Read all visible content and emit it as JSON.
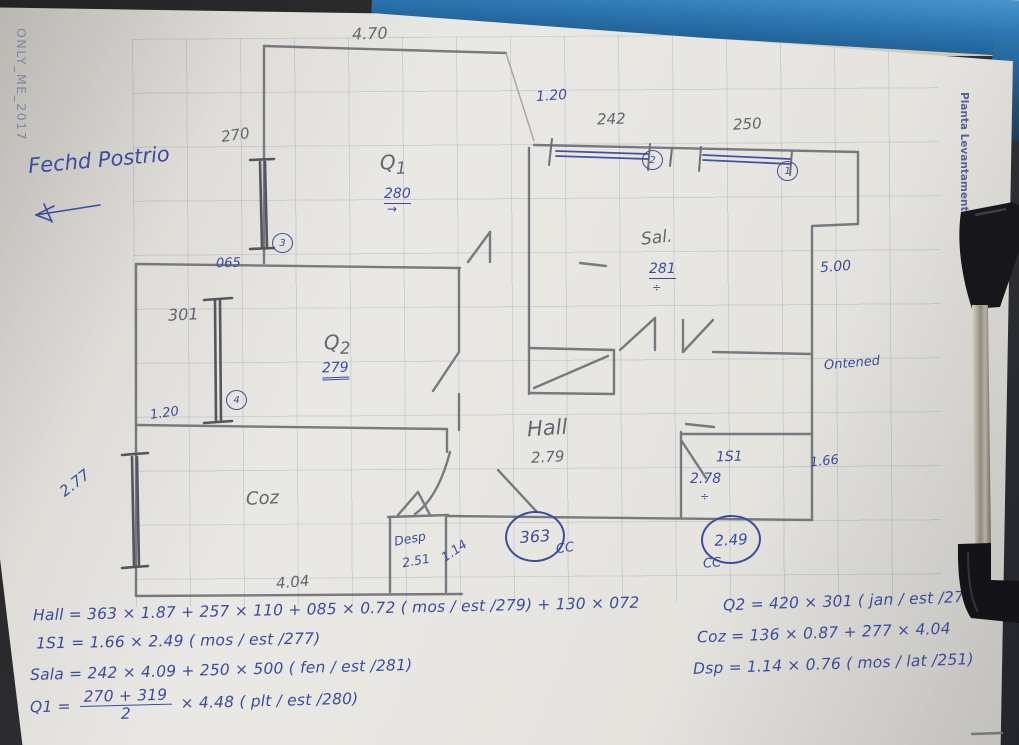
{
  "colors": {
    "ink": "#3d4c9e",
    "pencil": "#63666f",
    "clipboard_blue": "#2e78b5",
    "paper": "#e6e4df"
  },
  "watermarks": {
    "left": "ONLY_ME_2017",
    "right": "Planta Levantamento"
  },
  "notes": {
    "facade": "Fechd Postrio"
  },
  "plan": {
    "rooms": {
      "q1": "Q",
      "q1_sub": "1",
      "q2": "Q",
      "q2_sub": "2",
      "sala": "Sal.",
      "hall": "Hall",
      "coz": "Coz",
      "desp": "Desp",
      "is1": "1S1",
      "outside": "Ontened"
    },
    "dims": {
      "top": "4.70",
      "top_right_gap": "1.20",
      "win2": "242",
      "win1": "250",
      "left_win": "270",
      "ledge": "065",
      "q1_h": "280",
      "sala_h": "281",
      "right": "5.00",
      "q2_win": "301",
      "q2_gap": "1.20",
      "q2_h": "279",
      "hall_h": "2.79",
      "hall_w": "363",
      "is1_h": "2.78",
      "is1_w": "1.66",
      "is1_d": "2.49",
      "coz_win": "2.77",
      "desp_w": "2.51",
      "desp_gap": "1.14",
      "coz_w": "4.04"
    },
    "window_tags": {
      "w1": "1",
      "w2": "2",
      "w3": "3",
      "w4": "4"
    },
    "marks": {
      "cc_left": "CC",
      "cc_right": "CC",
      "arrow": "→",
      "divide": "÷",
      "divide2": "÷"
    }
  },
  "equations": {
    "hall": "Hall = 363 × 1.87 + 257 × 110 + 085 × 0.72 ( mos / est /279) + 130 × 072",
    "is1": "1S1 = 1.66 × 2.49 ( mos / est /277)",
    "sala": "Sala = 242 × 4.09 + 250 × 500 ( fen / est /281)",
    "q1_lhs": "Q1 =",
    "q1_num": "270 + 319",
    "q1_den": "2",
    "q1_rhs": "× 4.48  ( plt / est /280)",
    "q2": "Q2 = 420 × 301 ( jan / est /279)",
    "coz": "Coz = 136 × 0.87 + 277 × 4.04",
    "dsp": "Dsp = 1.14 × 0.76 ( mos / lat /251)"
  }
}
